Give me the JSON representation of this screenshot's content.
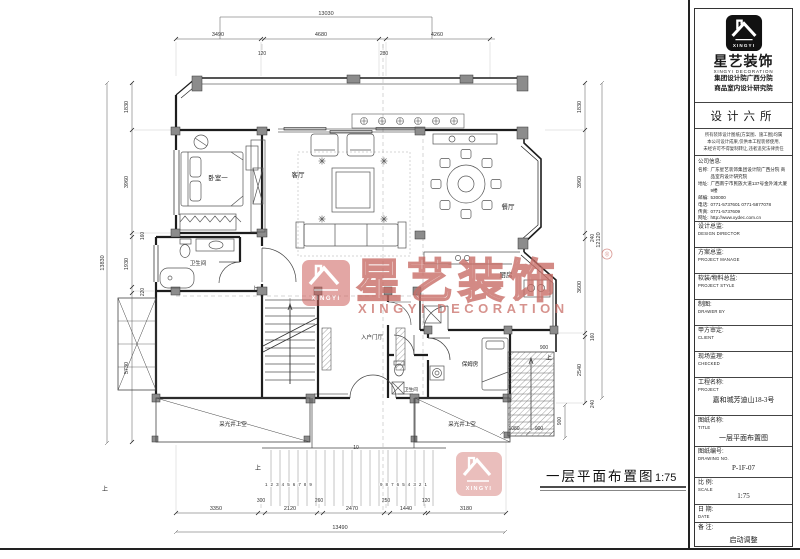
{
  "meta": {
    "sheet_caption": "一层平面布置图",
    "sheet_scale": "1:75"
  },
  "watermark": {
    "brand_cn": "星艺装饰",
    "brand_en": "XINGYI DECORATION",
    "reg": "®",
    "logo_text": "XINGYI"
  },
  "rooms": {
    "bedroom": "卧室一",
    "living": "客厅",
    "dining": "餐厅",
    "bathroom": "卫生间",
    "kitchen": "厨房",
    "entry_hall": "入户门厅",
    "maid_room": "保姆房",
    "bathroom2": "卫生间",
    "lightwell_left": "采光井上空",
    "lightwell_right": "采光井上空"
  },
  "annotations": {
    "up": "上",
    "steps_asc": "1 2 3 4 5 6 7 8 9",
    "steps_desc": "9 8 7 6 5 4 3 2 1",
    "step_ten": "10"
  },
  "dims": {
    "top_total": "13030",
    "top": [
      "3490",
      "120",
      "4680",
      "280",
      "4260"
    ],
    "left_total": "13830",
    "left": [
      "1830",
      "3960",
      "160",
      "1930",
      "220",
      "5730"
    ],
    "right_total": "12120",
    "right": [
      "1830",
      "3960",
      "240",
      "3600",
      "160",
      "2540",
      "240"
    ],
    "bottom_total": "13490",
    "bottom": [
      "3350",
      "300",
      "2120",
      "260",
      "2470",
      "250",
      "1440",
      "120",
      "3180"
    ],
    "stair": {
      "top": "900",
      "side": "900",
      "bottom_a": "1080",
      "bottom_b": "900"
    }
  },
  "title_block": {
    "logo": {
      "logo_text": "XINGYI",
      "brand_cn": "星艺装饰",
      "brand_en": "XINGYI DECORATION",
      "org1": "集团设计院广西分院",
      "org2": "商品室内设计研究院"
    },
    "studio": "设计六所",
    "disclaimer": [
      "所有装饰设计图纸(方案图、施工图)均属",
      "本公司设计成果,仅供本工程装修使用,",
      "未经许可不得复制转让,违者追究法律责任"
    ],
    "company": {
      "heading": "公司信息:",
      "rows": [
        {
          "label": "名称:",
          "value": "广东星艺装饰集团设计院广西分院 商品室内设计研究院"
        },
        {
          "label": "地址:",
          "value": "广西南宁市民族大道137号金外滩大厦9楼"
        },
        {
          "label": "邮编:",
          "value": "530000"
        },
        {
          "label": "电话:",
          "value": "0771-5737601  0771-5877078"
        },
        {
          "label": "传真:",
          "value": "0771-5737609"
        },
        {
          "label": "网址:",
          "value": "http://www.xydec.com.cn"
        }
      ]
    },
    "fields": [
      {
        "cn": "设计总监:",
        "en": "DESIGN DIRECTOR",
        "value": ""
      },
      {
        "cn": "方案总监:",
        "en": "PROJECT MANAGE",
        "value": ""
      },
      {
        "cn": "软装/物料总监:",
        "en": "PROJECT STYLE",
        "value": ""
      },
      {
        "cn": "制图:",
        "en": "DRAWER BY",
        "value": ""
      },
      {
        "cn": "甲方审定:",
        "en": "CLIENT",
        "value": ""
      },
      {
        "cn": "现场监理:",
        "en": "CHECKED",
        "value": ""
      },
      {
        "cn": "工程名称:",
        "en": "PROJECT",
        "value": "嘉和城芳迪山18-3号"
      },
      {
        "cn": "图纸名称:",
        "en": "TITLE",
        "value": "一层平面布置图"
      },
      {
        "cn": "图纸编号:",
        "en": "DRAWING NO.",
        "value": "P-1F-07"
      },
      {
        "cn": "比 例:",
        "en": "SCALE",
        "value": "1:75"
      },
      {
        "cn": "日 期:",
        "en": "DATE",
        "value": ""
      },
      {
        "cn": "备 注:",
        "en": "",
        "value": "启动调整"
      }
    ]
  }
}
